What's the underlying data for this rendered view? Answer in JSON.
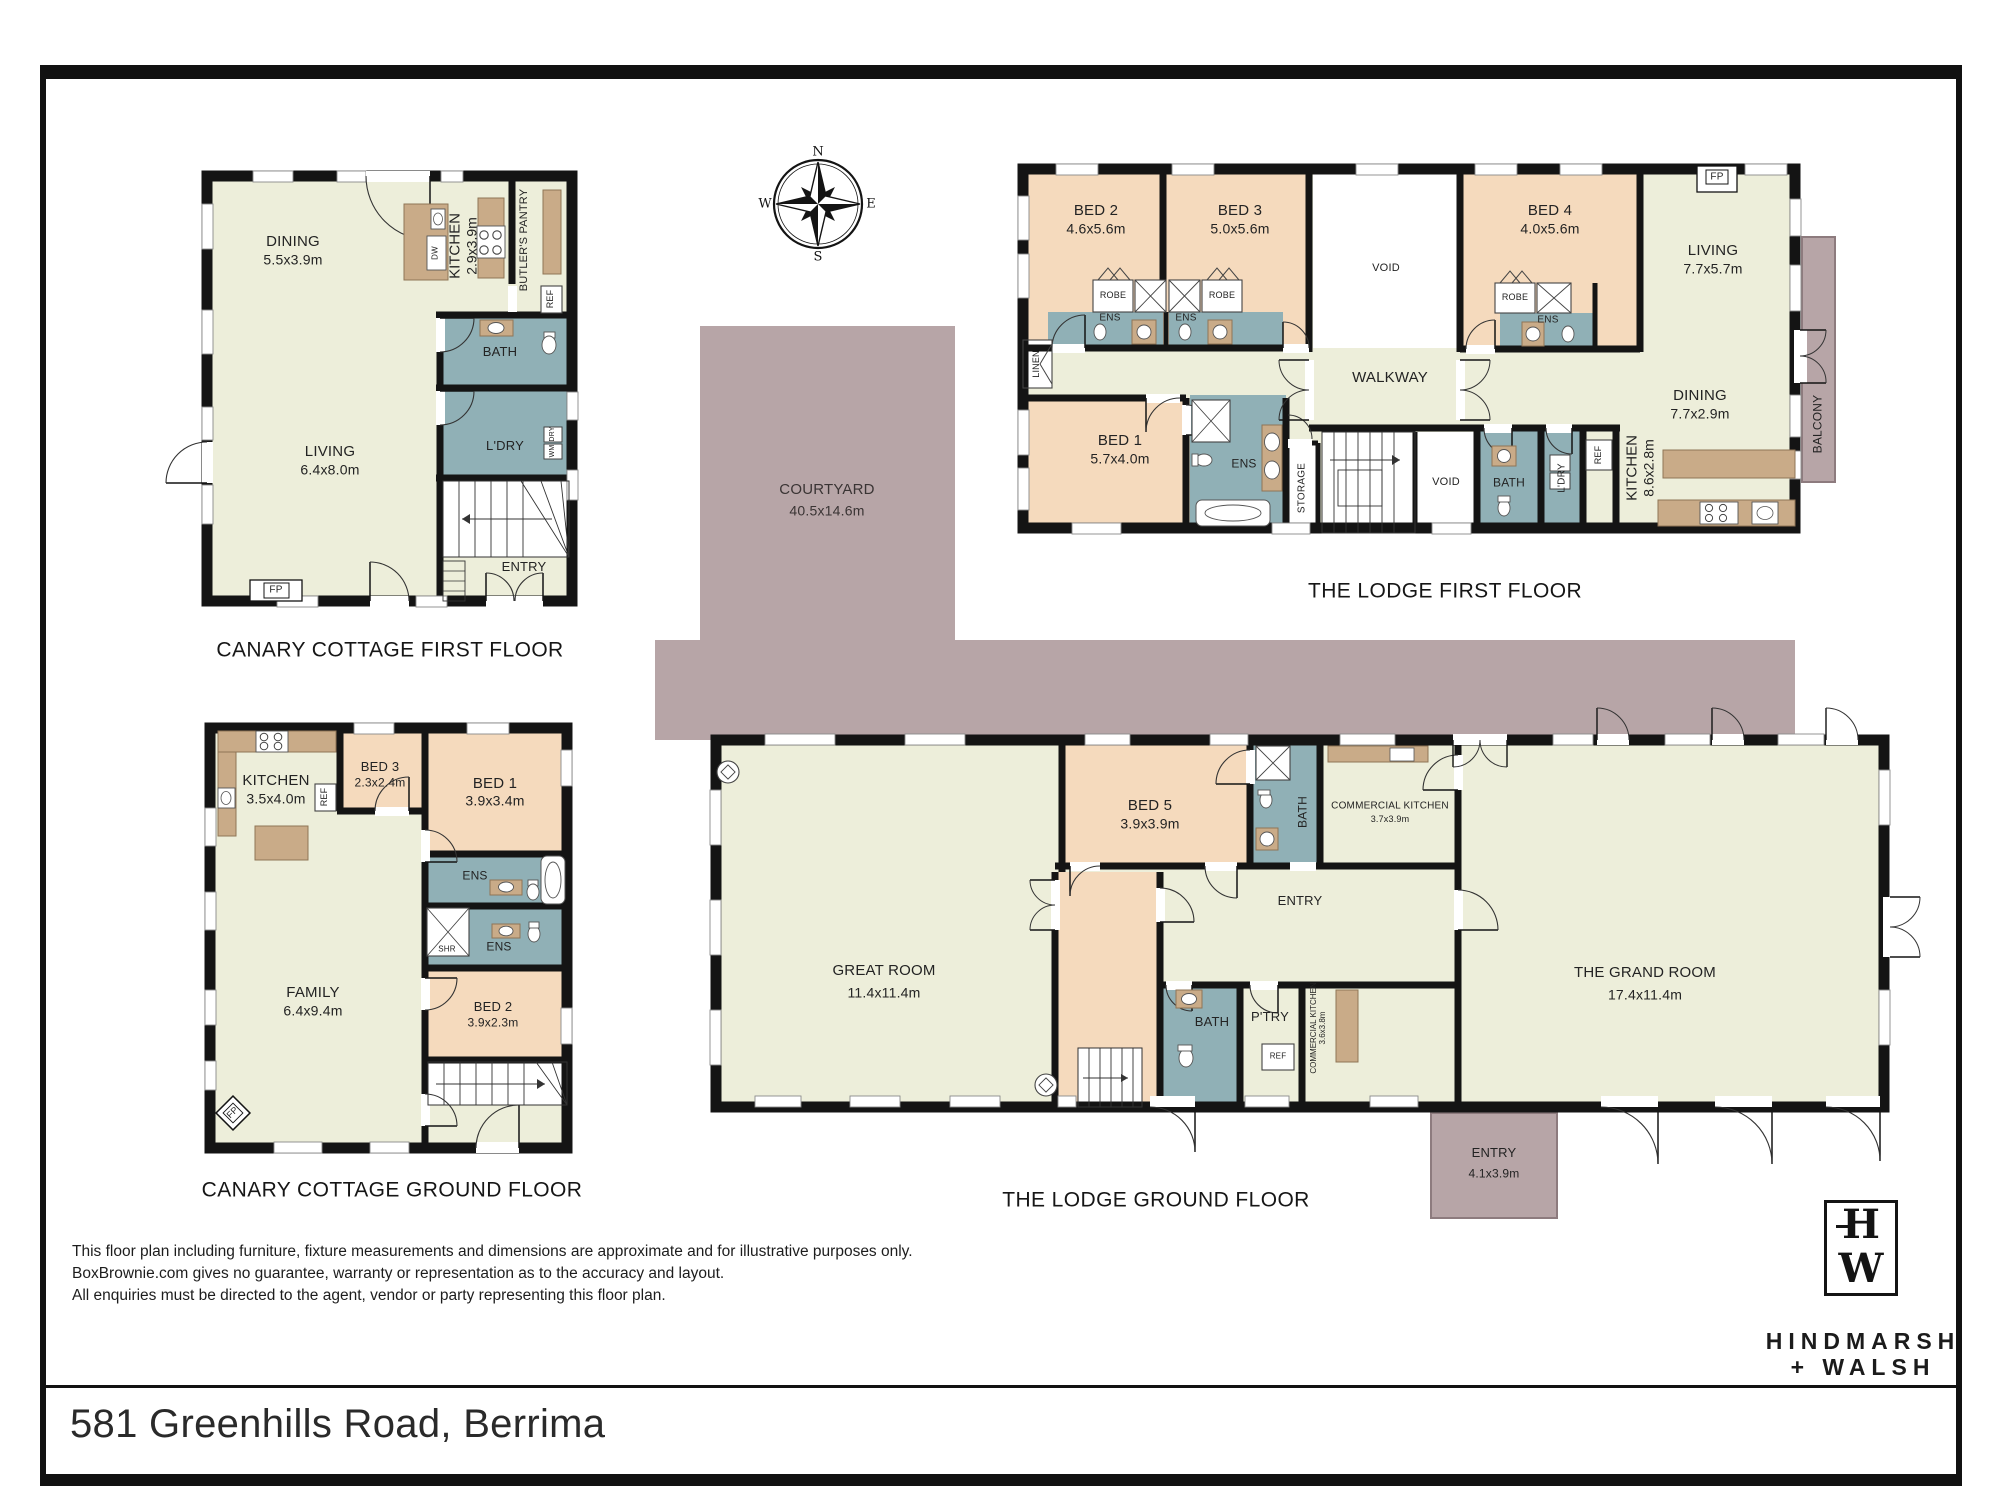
{
  "sheet": {
    "address": "581 Greenhills Road, Berrima",
    "disclaimer": [
      "This floor plan including furniture, fixture measurements and dimensions are approximate and for illustrative purposes only.",
      "BoxBrownie.com gives no guarantee, warranty or representation as to the accuracy and layout.",
      "All enquiries must be directed to the agent, vendor or party representing this floor plan."
    ],
    "brand": {
      "logo_top": "H",
      "logo_bottom": "W",
      "line1": "HINDMARSH",
      "line2": "+ WALSH"
    },
    "compass": {
      "n": "N",
      "e": "E",
      "s": "S",
      "w": "W"
    }
  },
  "courtyard": {
    "name": "COURTYARD",
    "dims": "40.5x14.6m"
  },
  "canary_cottage_first_floor": {
    "title": "CANARY COTTAGE FIRST FLOOR",
    "rooms": {
      "dining": {
        "name": "DINING",
        "dims": "5.5x3.9m"
      },
      "kitchen": {
        "name": "KITCHEN",
        "dims": "2.9x3.9m"
      },
      "butlers_pantry": {
        "name": "BUTLER'S PANTRY"
      },
      "bath": {
        "name": "BATH"
      },
      "laundry": {
        "name": "L'DRY"
      },
      "living": {
        "name": "LIVING",
        "dims": "6.4x8.0m"
      },
      "entry": {
        "name": "ENTRY"
      }
    },
    "fixtures": {
      "ref": "REF",
      "dw": "DW",
      "dry": "DRY",
      "wm": "WM",
      "fp": "FP"
    }
  },
  "canary_cottage_ground_floor": {
    "title": "CANARY COTTAGE GROUND FLOOR",
    "rooms": {
      "kitchen": {
        "name": "KITCHEN",
        "dims": "3.5x4.0m"
      },
      "bed3": {
        "name": "BED 3",
        "dims": "2.3x2.4m"
      },
      "bed1": {
        "name": "BED 1",
        "dims": "3.9x3.4m"
      },
      "ens_a": {
        "name": "ENS"
      },
      "ens_b": {
        "name": "ENS"
      },
      "family": {
        "name": "FAMILY",
        "dims": "6.4x9.4m"
      },
      "bed2": {
        "name": "BED 2",
        "dims": "3.9x2.3m"
      }
    },
    "fixtures": {
      "ref": "REF",
      "shr": "SHR",
      "fp": "FP"
    }
  },
  "lodge_first_floor": {
    "title": "THE LODGE FIRST FLOOR",
    "rooms": {
      "bed2": {
        "name": "BED 2",
        "dims": "4.6x5.6m"
      },
      "bed3": {
        "name": "BED 3",
        "dims": "5.0x5.6m"
      },
      "bed4": {
        "name": "BED 4",
        "dims": "4.0x5.6m"
      },
      "living": {
        "name": "LIVING",
        "dims": "7.7x5.7m"
      },
      "dining": {
        "name": "DINING",
        "dims": "7.7x2.9m"
      },
      "kitchen": {
        "name": "KITCHEN",
        "dims": "8.6x2.8m"
      },
      "bed1": {
        "name": "BED 1",
        "dims": "5.7x4.0m"
      },
      "walkway": {
        "name": "WALKWAY"
      },
      "void_upper": {
        "name": "VOID"
      },
      "void_lower": {
        "name": "VOID"
      },
      "bath": {
        "name": "BATH"
      },
      "laundry": {
        "name": "L'DRY"
      },
      "linen": {
        "name": "LINEN"
      },
      "storage": {
        "name": "STORAGE"
      },
      "balcony": {
        "name": "BALCONY"
      },
      "ens_a": {
        "name": "ENS"
      },
      "ens_b": {
        "name": "ENS"
      },
      "ens_c": {
        "name": "ENS"
      },
      "ens_bed1": {
        "name": "ENS"
      }
    },
    "fixtures": {
      "robe": "ROBE",
      "ref": "REF",
      "fp": "FP",
      "shr": "SHR"
    }
  },
  "lodge_ground_floor": {
    "title": "THE LODGE GROUND FLOOR",
    "rooms": {
      "great_room": {
        "name": "GREAT ROOM",
        "dims": "11.4x11.4m"
      },
      "grand_room": {
        "name": "THE GRAND ROOM",
        "dims": "17.4x11.4m"
      },
      "bed5": {
        "name": "BED 5",
        "dims": "3.9x3.9m"
      },
      "bath_upper": {
        "name": "BATH"
      },
      "commercial_kitchen_upper": {
        "name": "COMMERCIAL KITCHEN",
        "dims": "3.7x3.9m"
      },
      "entry": {
        "name": "ENTRY"
      },
      "bath_lower": {
        "name": "BATH"
      },
      "pantry": {
        "name": "P'TRY"
      },
      "commercial_kitchen_lower": {
        "name": "COMMERCIAL KITCHEN",
        "dims": "3.6x3.8m"
      },
      "entry_porch": {
        "name": "ENTRY",
        "dims": "4.1x3.9m"
      }
    },
    "fixtures": {
      "ref": "REF",
      "fp": "FP"
    }
  }
}
